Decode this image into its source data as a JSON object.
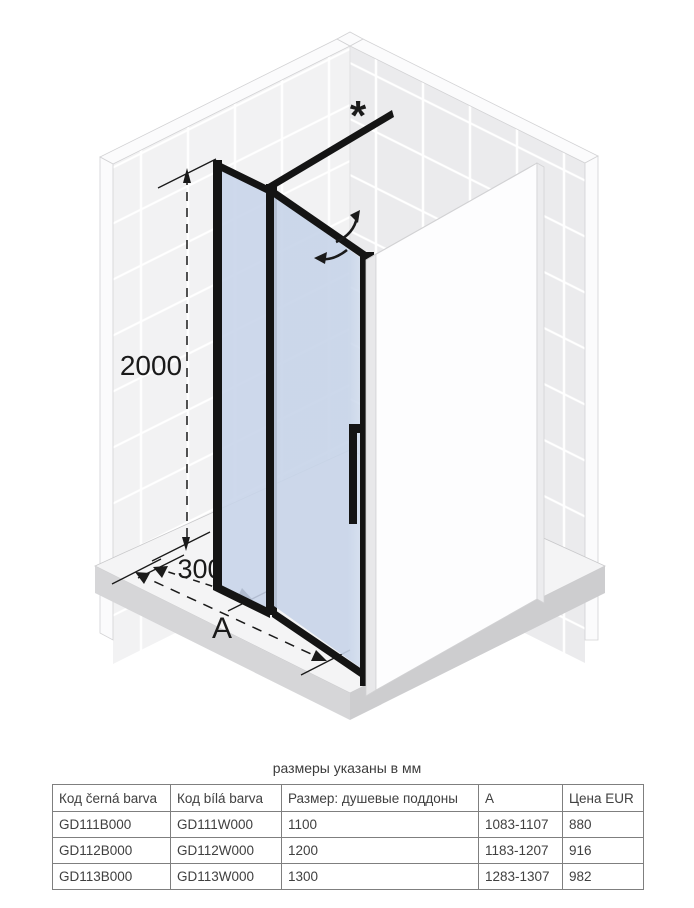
{
  "diagram": {
    "labels": {
      "height": "2000",
      "panel_width": "300",
      "total_width": "A",
      "asterisk": "*"
    },
    "icons": {
      "swing_up_arrow": "curved-arrow-up-right",
      "swing_left_arrow": "curved-arrow-left"
    }
  },
  "note": "размеры указаны в мм",
  "table": {
    "headers": [
      "Код černá barva",
      "Код bílá barva",
      "Размер: душевые поддоны",
      "A",
      "Цена EUR"
    ],
    "rows": [
      [
        "GD111B000",
        "GD111W000",
        "1100",
        "1083-1107",
        "880"
      ],
      [
        "GD112B000",
        "GD112W000",
        "1200",
        "1183-1207",
        "916"
      ],
      [
        "GD113B000",
        "GD113W000",
        "1300",
        "1283-1307",
        "982"
      ]
    ]
  },
  "colors": {
    "frame": "#141414",
    "glass": "#c7d4e9",
    "glass-light": "#dde6f2",
    "tile-left": "#f2f2f3",
    "tile-right": "#ebebed",
    "grout": "#ffffff",
    "wall-edge": "#fbfbfc",
    "wall-edge-stroke": "#d2d2d4",
    "slab-top": "#f4f4f5",
    "slab-side": "#d6d6d8",
    "slab-side2": "#cdcdcf",
    "panel-face": "#fdfdfe",
    "panel-edge": "#e8e8ea",
    "panel-right": "#ececee",
    "line": "#1a1a1a",
    "table-border": "#7f7f7f",
    "text": "#404040"
  }
}
